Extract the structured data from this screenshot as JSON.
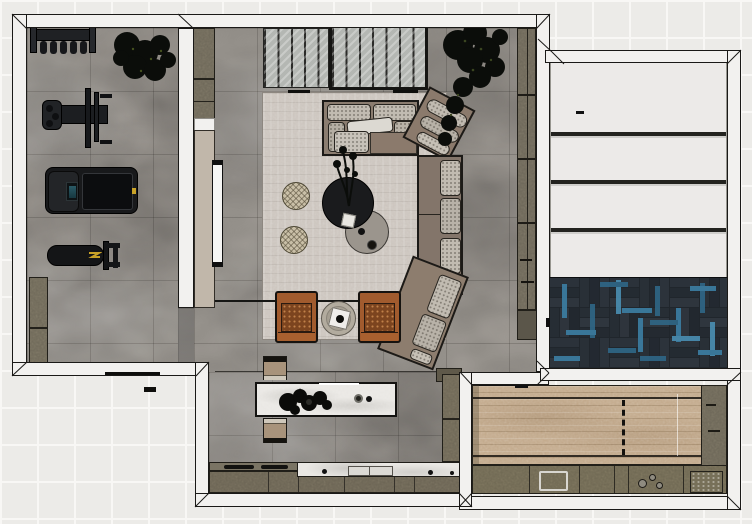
{
  "canvas": {
    "width": 752,
    "height": 524,
    "view": "top-down 3D floor plan render",
    "background": "light tile grid"
  },
  "palette": {
    "background_tile": "#ecebe8",
    "wall_fill": "#f2f1ef",
    "wall_outline": "#1a1917",
    "stone_floor": "#817d78",
    "rug": "#ccc5be",
    "sofa_frame": "#857565",
    "sofa_cushion": "#c1bbb1",
    "armchair": "#a15b2e",
    "coffee_table_dark": "#1a1b1d",
    "coffee_table_gray": "#9b958d",
    "cabinet_olive": "#6d6758",
    "island_marble": "#eae8e4",
    "media_panel": "#c1b7aa",
    "garage_panel": "#eceae8",
    "herringbone_base": "#232930",
    "herringbone_blue": "#3c7fa4",
    "wood_floor": "#c3aa8c",
    "plant": "#0b0d0a",
    "accent_yellow": "#c9a227",
    "tv": "#f6f6f4"
  },
  "rooms": [
    {
      "id": "gym",
      "label": "Home gym",
      "floor": "gray stone tile"
    },
    {
      "id": "living",
      "label": "Living room",
      "floor": "gray stone tile with area rug"
    },
    {
      "id": "kitchen",
      "label": "Kitchen",
      "floor": "gray stone tile"
    },
    {
      "id": "garage",
      "label": "Garage with sectional door and blue herringbone floor"
    },
    {
      "id": "utility",
      "label": "Utility room with wood floor and built-in cabinets"
    },
    {
      "id": "exterior",
      "label": "Exterior tiled surround"
    }
  ],
  "furniture": {
    "gym": [
      "weight rack with plates",
      "cable machine",
      "treadmill",
      "workout bench",
      "storage cabinet",
      "plant"
    ],
    "living": [
      "corner sectional sofa",
      "white throw pillow",
      "angled chaise",
      "round dark coffee table with plant",
      "round gray side table",
      "two round poufs",
      "two cognac leather armchairs",
      "round side table with tray",
      "wall-mounted TV on media panel",
      "glazed sliding partition",
      "tall shelf unit",
      "indoor tree"
    ],
    "kitchen": [
      "marble island with decor",
      "two island stools",
      "cooktop counter",
      "marble sink counter",
      "base cabinets",
      "pantry column"
    ],
    "utility": [
      "wood platform with dashed divider",
      "side cabinet column",
      "base cabinets with sink and hobs"
    ]
  }
}
